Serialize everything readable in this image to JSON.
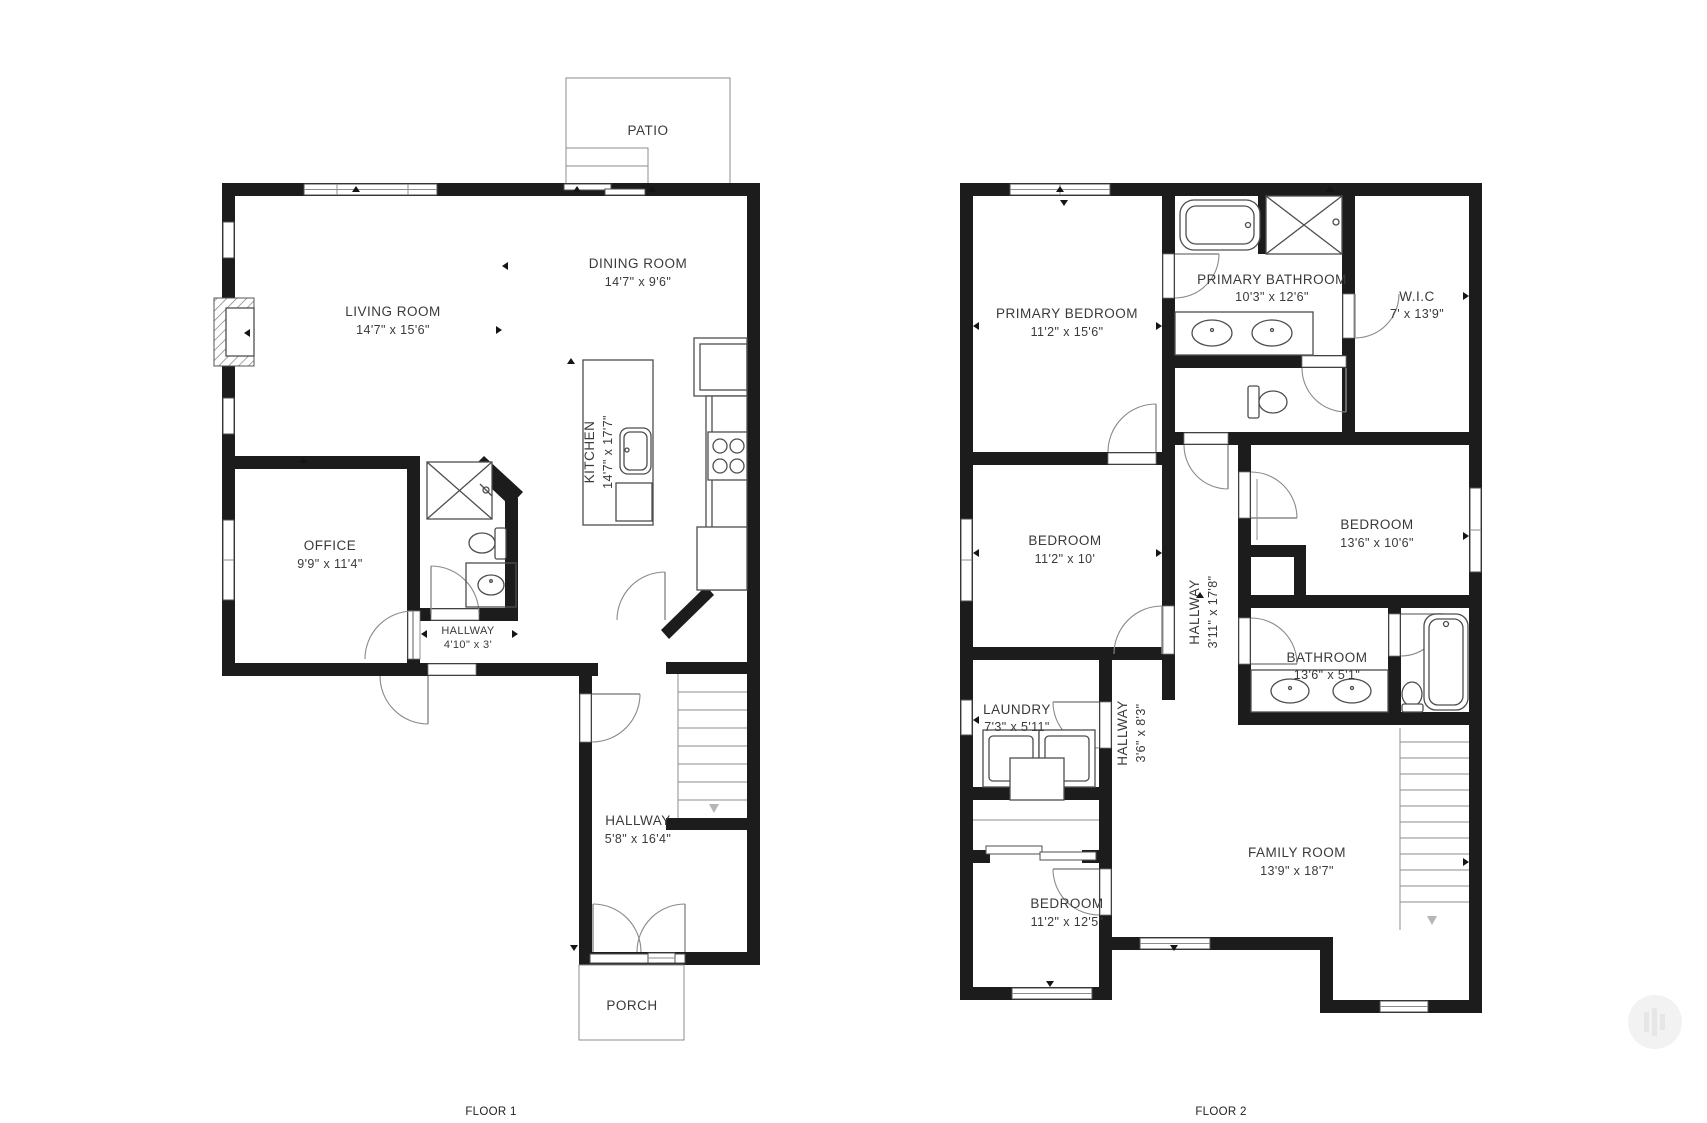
{
  "colors": {
    "wall": "#1c1c1c",
    "fixture_line": "#4d4d4d",
    "thin_line": "#8c8c8c",
    "text": "#3a3a3a",
    "background": "#ffffff"
  },
  "floor1": {
    "name_label": "FLOOR 1",
    "rooms": {
      "patio": {
        "name": "PATIO"
      },
      "dining": {
        "name": "DINING ROOM",
        "dims": "14'7\" x 9'6\""
      },
      "living": {
        "name": "LIVING ROOM",
        "dims": "14'7\" x 15'6\""
      },
      "kitchen": {
        "name": "KITCHEN",
        "dims": "14'7\" x 17'7\""
      },
      "office": {
        "name": "OFFICE",
        "dims": "9'9\" x 11'4\""
      },
      "hallway_small": {
        "name": "HALLWAY",
        "dims": "4'10\" x 3'"
      },
      "hallway_main": {
        "name": "HALLWAY",
        "dims": "5'8\" x 16'4\""
      },
      "porch": {
        "name": "PORCH"
      }
    }
  },
  "floor2": {
    "name_label": "FLOOR 2",
    "rooms": {
      "primary_bedroom": {
        "name": "PRIMARY BEDROOM",
        "dims": "11'2\" x 15'6\""
      },
      "primary_bathroom": {
        "name": "PRIMARY BATHROOM",
        "dims": "10'3\" x 12'6\""
      },
      "wic": {
        "name": "W.I.C",
        "dims": "7' x 13'9\""
      },
      "bedroom_mid": {
        "name": "BEDROOM",
        "dims": "11'2\" x 10'"
      },
      "bedroom_right": {
        "name": "BEDROOM",
        "dims": "13'6\" x 10'6\""
      },
      "hallway_spine": {
        "name": "HALLWAY",
        "dims": "3'11\" x 17'8\""
      },
      "bathroom": {
        "name": "BATHROOM",
        "dims": "13'6\" x 5'1\""
      },
      "laundry": {
        "name": "LAUNDRY",
        "dims": "7'3\" x 5'11\""
      },
      "hallway_lower": {
        "name": "HALLWAY",
        "dims": "3'6\" x 8'3\""
      },
      "bedroom_bottom": {
        "name": "BEDROOM",
        "dims": "11'2\" x 12'5\""
      },
      "family_room": {
        "name": "FAMILY ROOM",
        "dims": "13'9\" x 18'7\""
      }
    }
  }
}
